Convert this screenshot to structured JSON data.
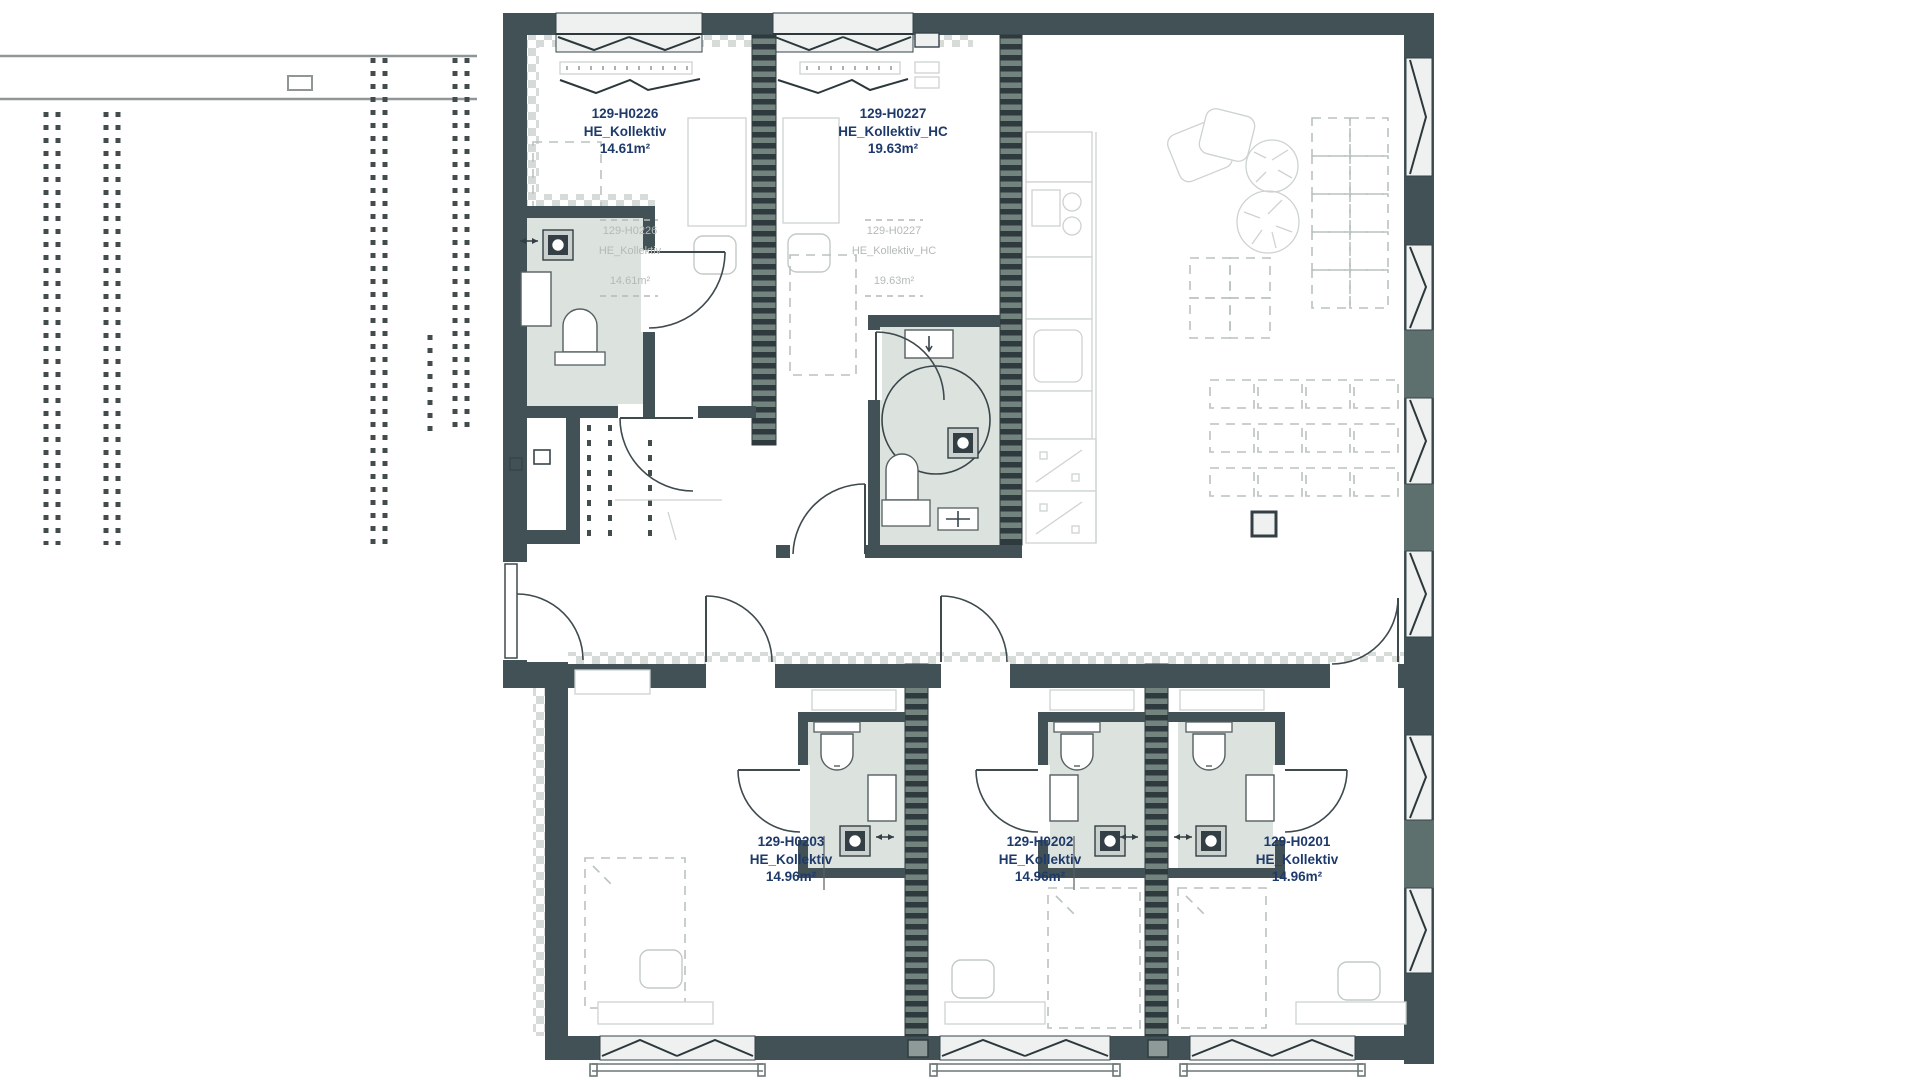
{
  "drawing": {
    "kind": "architectural floor plan",
    "rooms": [
      {
        "id": "129-H0226",
        "type": "HE_Kollektiv",
        "area": "14.61m²"
      },
      {
        "id": "129-H0227",
        "type": "HE_Kollektiv_HC",
        "area": "19.63m²"
      },
      {
        "id": "129-H0203",
        "type": "HE_Kollektiv",
        "area": "14.96m²"
      },
      {
        "id": "129-H0202",
        "type": "HE_Kollektiv",
        "area": "14.96m²"
      },
      {
        "id": "129-H0201",
        "type": "HE_Kollektiv",
        "area": "14.96m²"
      }
    ],
    "colors": {
      "wall": "#425156",
      "wall_stripe_dark": "#2e3a3e",
      "wall_stripe_light": "#73847f",
      "wall_pier": "#5d706d",
      "window_band": "#eef1f0",
      "bath_floor": "#dce2de",
      "label_text": "#1e3a6b",
      "ghost_text": "#b3bab7",
      "faint_furniture": "#ccd3d0"
    }
  }
}
